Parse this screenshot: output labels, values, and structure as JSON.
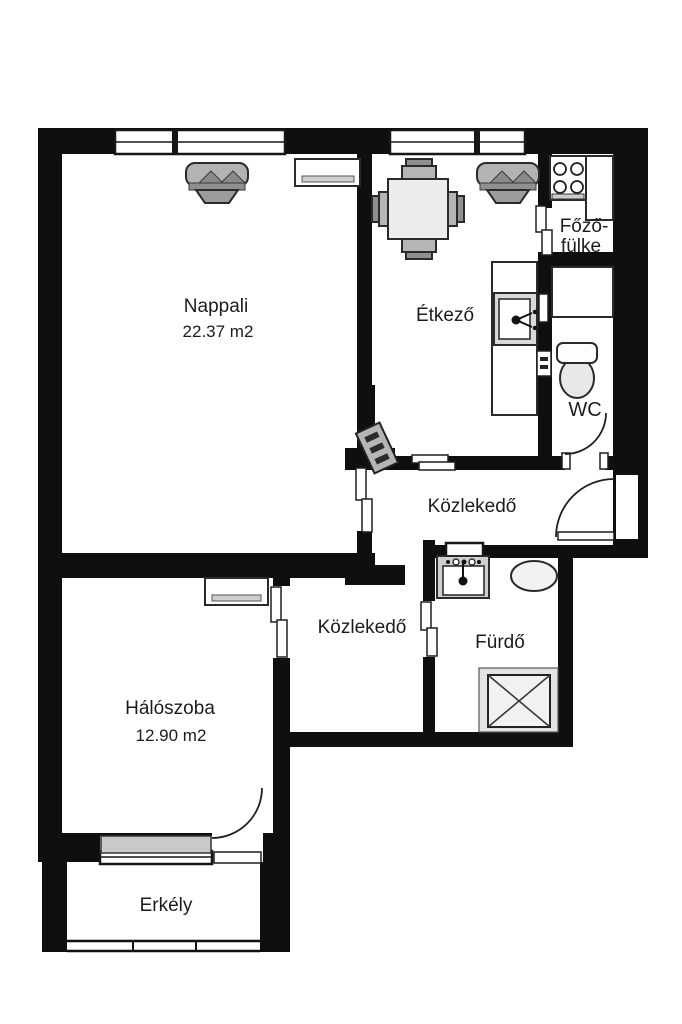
{
  "plan_type": "apartment-floor-plan",
  "colors": {
    "wall": "#0f0f0f",
    "background": "#ffffff",
    "furniture_light": "#ececec",
    "furniture_mid": "#b3b3b3",
    "furniture_dark": "#8a8a8a",
    "outline": "#2a2a2a"
  },
  "rooms": {
    "nappali": {
      "label": "Nappali",
      "area": "22.37 m2"
    },
    "etkezo": {
      "label": "Étkező"
    },
    "fozofulke": {
      "line1": "Főző-",
      "line2": "fülke"
    },
    "wc": {
      "label": "WC"
    },
    "kozlekedo_felso": {
      "label": "Közlekedő"
    },
    "kozlekedo_also": {
      "label": "Közlekedő"
    },
    "furdo": {
      "label": "Fürdő"
    },
    "haloszoba": {
      "label": "Hálószoba",
      "area": "12.90 m2"
    },
    "erkely": {
      "label": "Erkély"
    }
  }
}
